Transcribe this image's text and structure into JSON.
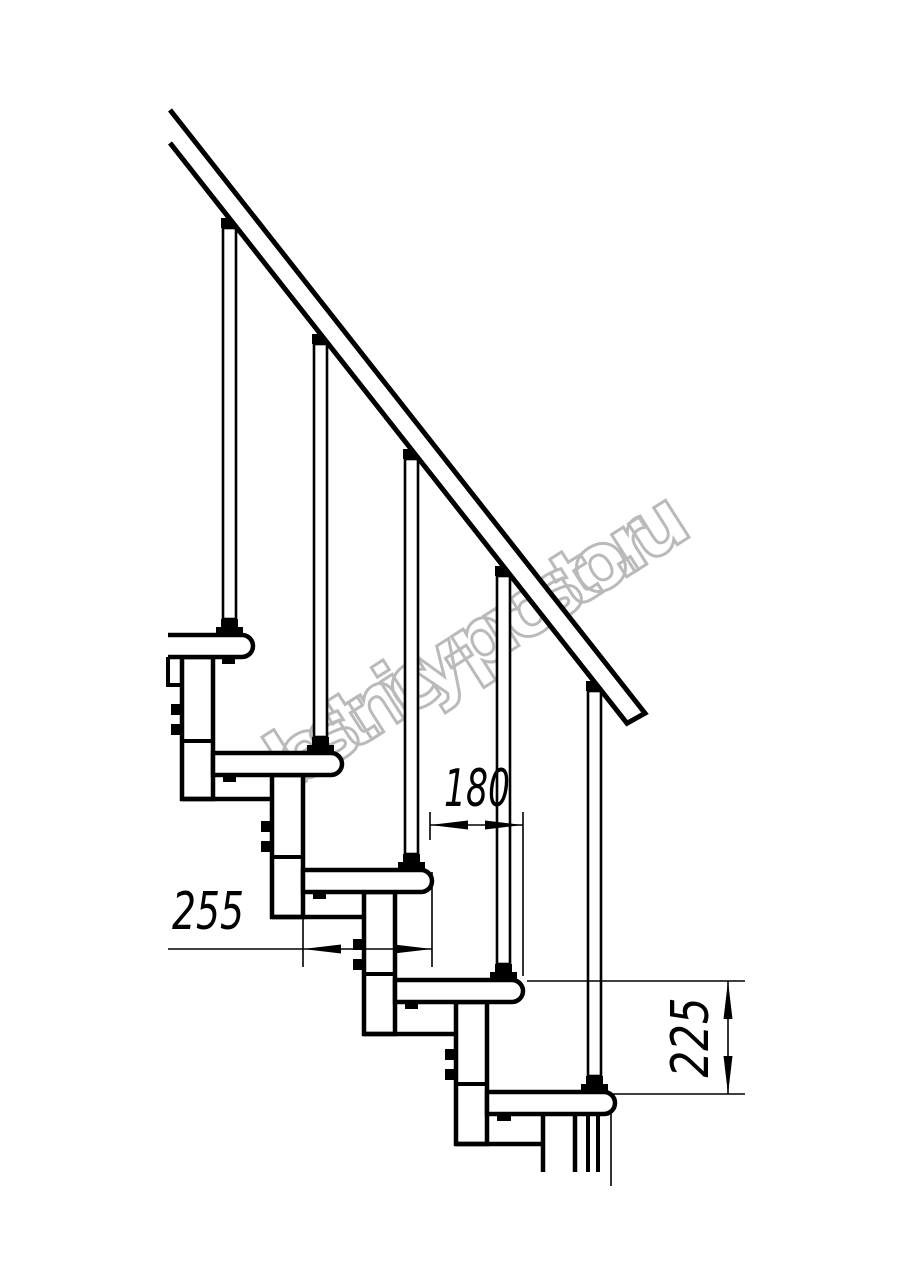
{
  "canvas": {
    "width": 914,
    "height": 1280,
    "background": "#ffffff",
    "ink": "#000000"
  },
  "watermark": {
    "text": "lestnicy-prosto.ru",
    "color": "#b3b3b3"
  },
  "dimensions": {
    "run": {
      "label": "180"
    },
    "depth": {
      "label": "255"
    },
    "rise": {
      "label": "225"
    }
  },
  "structure": {
    "tread_count": 5,
    "baluster_count": 5
  }
}
